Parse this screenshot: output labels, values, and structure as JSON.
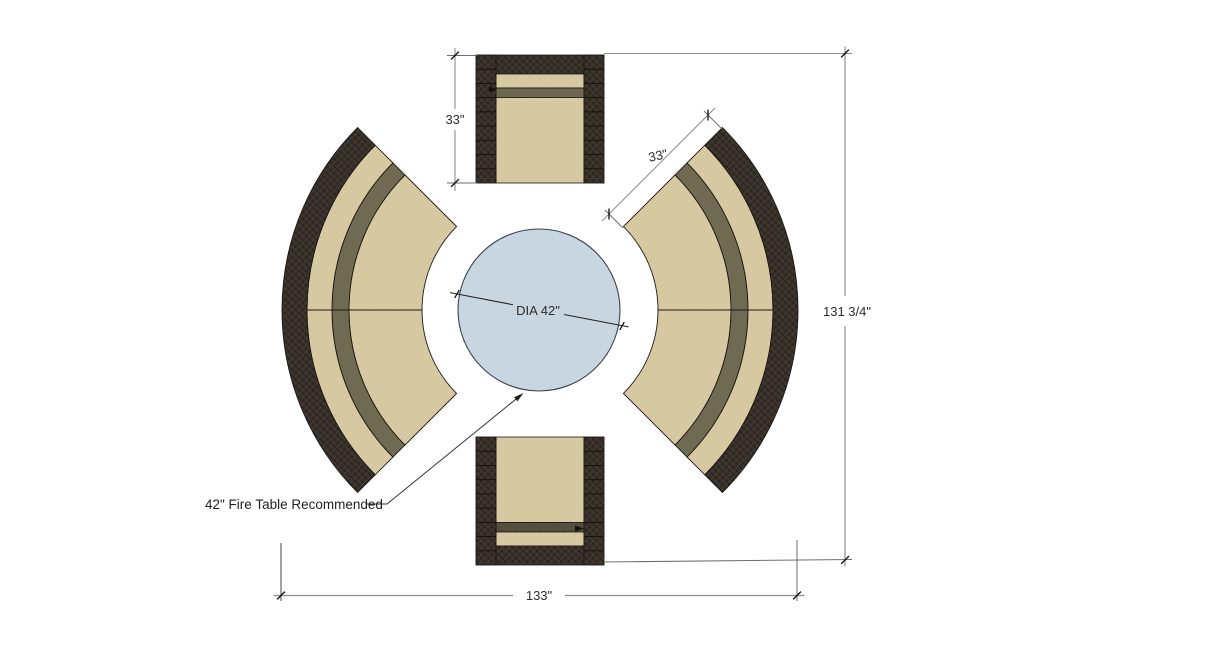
{
  "diagram": {
    "labels": {
      "chair_size": "33\"",
      "sofa_depth": "33\"",
      "overall_height": "131 3/4\"",
      "overall_width": "133\"",
      "fire_table_diameter": "DIA 42\"",
      "fire_table_note": "42\" Fire Table Recommended"
    },
    "colors": {
      "background": "#ffffff",
      "cushion_tan": "#d7caa3",
      "cushion_tan_line": "#c9bb92",
      "band_olive_sofa": "#716a52",
      "band_olive_top_chair": "#6e6750",
      "band_olive_bottom_chair": "#554e3f",
      "wicker_dark": "#38302a",
      "wicker_line": "#241f19",
      "wicker_highlight": "#473d32",
      "outline": "#1c1812",
      "fire_table_fill": "#c7d6e1",
      "fire_table_stroke": "#3a434e",
      "dim_line": "#8e8e8e",
      "dim_ext": "#6e6e6e",
      "dim_tick": "#111111",
      "dim_text": "#2d2d2d",
      "leader_line": "#333333"
    }
  }
}
